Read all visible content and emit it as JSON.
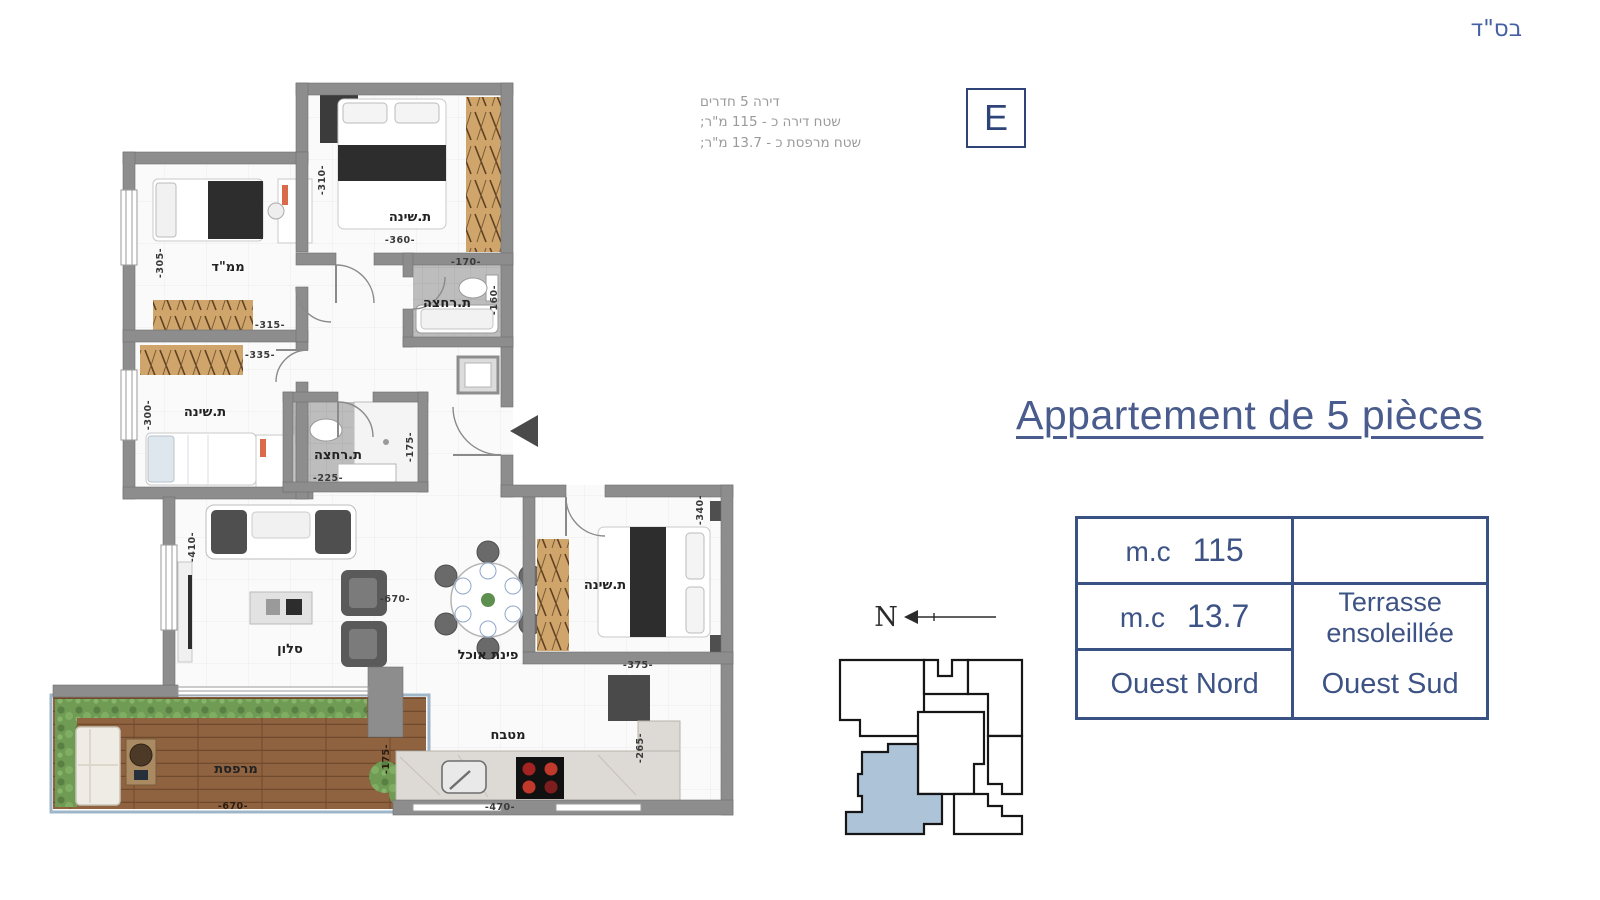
{
  "header": {
    "bsd": "בס\"ד"
  },
  "spec": {
    "line1": "דירה 5 חדרים",
    "line2": "שטח דירה כ - 115 מ\"ר;",
    "line3": "שטח מרפסת כ - 13.7 מ\"ר;",
    "unit_letter": "E"
  },
  "title": "Appartement de 5 pièces",
  "info_table": {
    "r1c1_label": "m.c",
    "r1c1_value": "115",
    "r1c2": "",
    "r2c1_label": "m.c",
    "r2c1_value": "13.7",
    "r2c2_line1": "Terrasse",
    "r2c2_line2": "ensoleillée",
    "r3c1": "Ouest Nord",
    "r3c2": "Ouest Sud"
  },
  "compass": {
    "north_label": "N"
  },
  "floorplan": {
    "rooms": {
      "bedroom_top": "ת.שינה",
      "mamad": "ממ\"ד",
      "bathroom_top": "ת.רחצה",
      "bathroom_mid": "ת.רחצה",
      "bedroom_left": "ת.שינה",
      "living_room": "סלון",
      "dining": "פינת אוכל",
      "bedroom_master": "ת.שינה",
      "kitchen": "מטבח",
      "terrace": "מרפסת"
    },
    "dims": {
      "bedroom_top_h": "-310-",
      "bedroom_top_w": "-360-",
      "bathroom_top_w": "-170-",
      "bathroom_top_h": "-160-",
      "mamad_h": "-305-",
      "mamad_w": "-315-",
      "bedroom_left_w": "-335-",
      "bedroom_left_h": "-300-",
      "bathroom_mid_w": "-225-",
      "bathroom_mid_h": "-175-",
      "living_h": "-410-",
      "living_w": "-670-",
      "bedroom_master_h": "-340-",
      "bedroom_master_w": "-375-",
      "kitchen_w": "-470-",
      "kitchen_h": "-265-",
      "terrace_w": "-670-",
      "terrace_h": "-175-"
    }
  },
  "colors": {
    "accent_blue": "#4a5c8d",
    "navy": "#2e4478",
    "table_border": "#3a5184",
    "unit_highlight": "#adc3d8",
    "wall_gray": "#8d8d8d"
  }
}
